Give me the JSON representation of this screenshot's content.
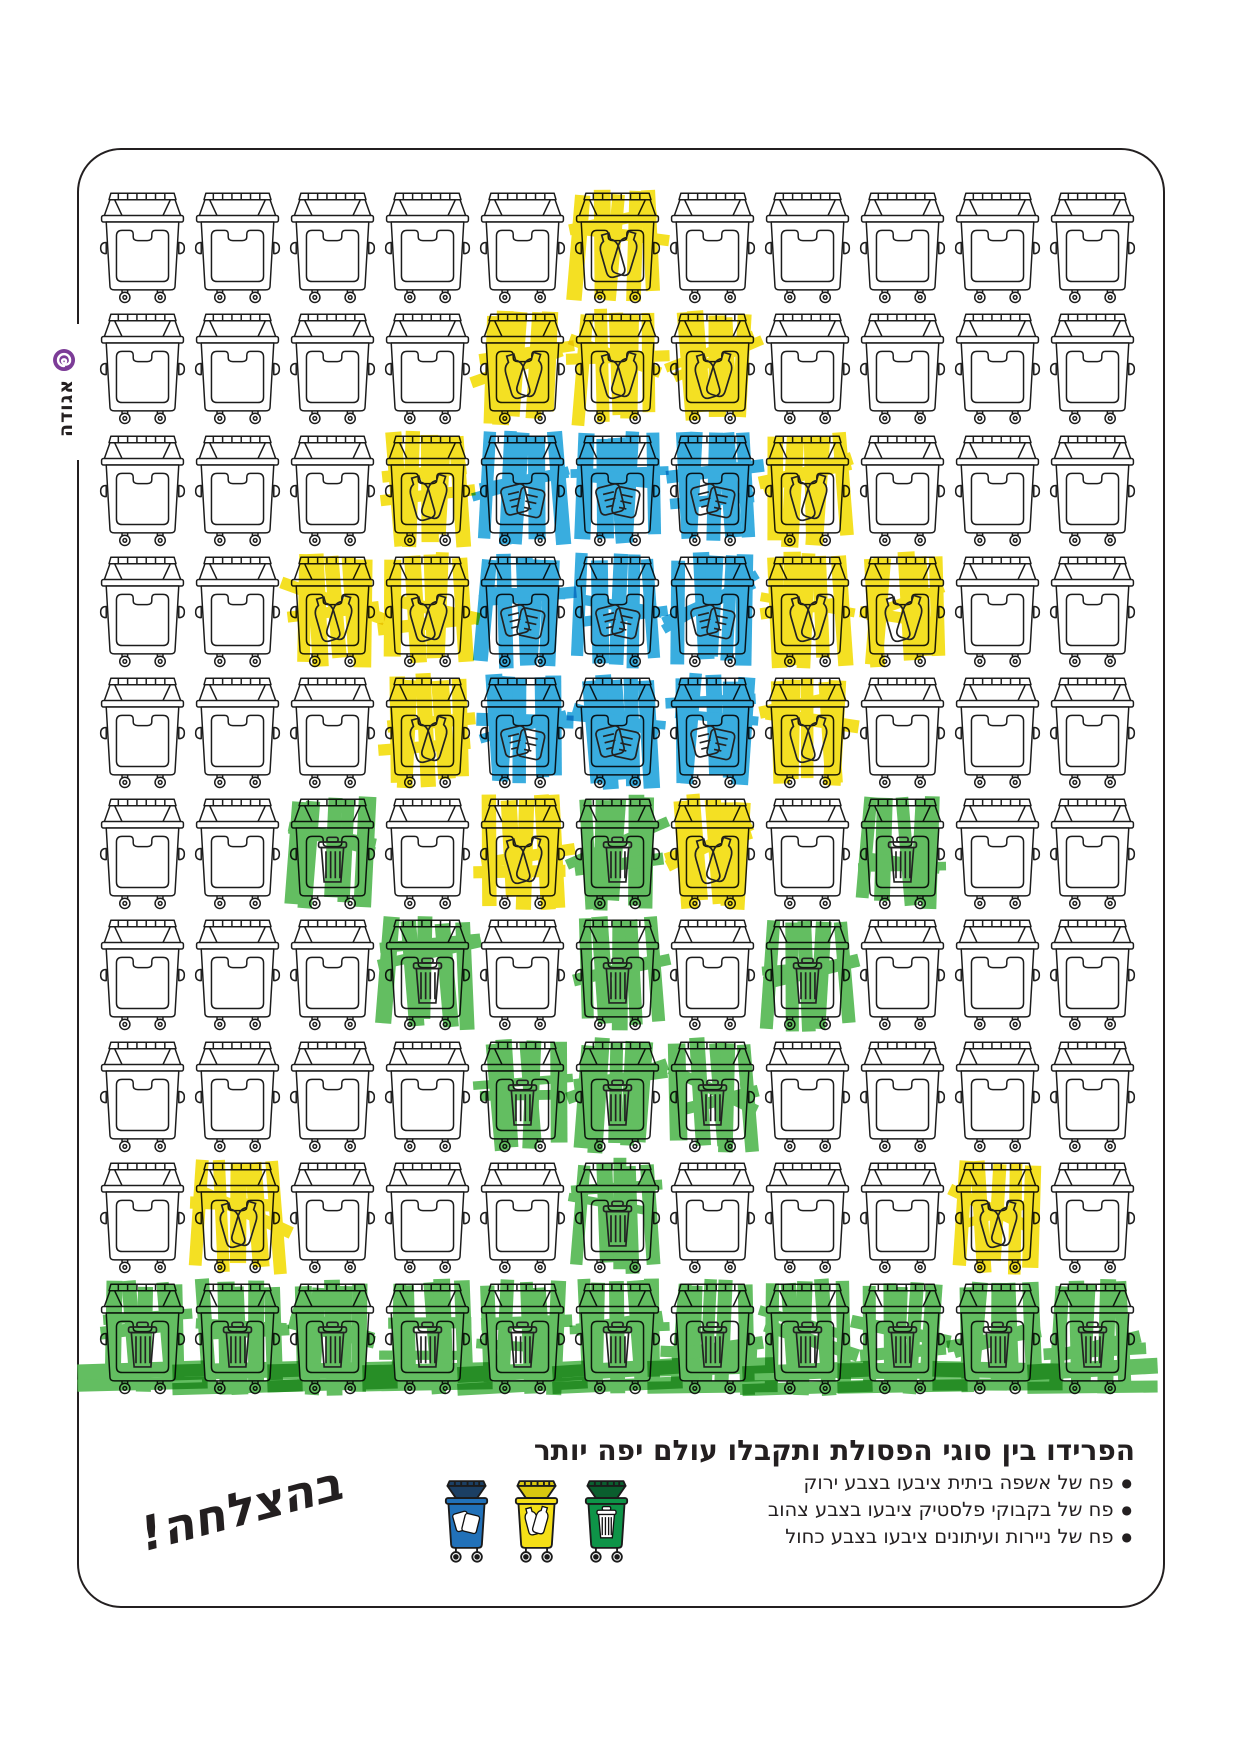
{
  "logo": {
    "text": "אגודה",
    "icon": "spiral-icon",
    "color": "#7c3c97"
  },
  "palette": {
    "ink": "#231f20",
    "yellow": "#f4df17",
    "blue": "#2ea9de",
    "green": "#5abb58",
    "legend_blue": "#2171b9",
    "legend_blue_lid": "#1b3f63",
    "legend_yellow": "#f4df17",
    "legend_yellow_lid": "#d9c70f",
    "legend_green": "#0e9448",
    "legend_green_lid": "#0a5e2e"
  },
  "grid": {
    "columns": 11,
    "rows": 10,
    "cells": [
      "WWWWWYWWWWW",
      "WWWWYYYWWWW",
      "WWWYBBBYWWW",
      "WWYYBBBYYWW",
      "WWWYBBBYWWW",
      "WWGWYGYWGWW",
      "WWWGWGWGWWW",
      "WWWWGGGWWWW",
      "WYWWWGWWWYW",
      "GGGGGGGGGGG"
    ],
    "glyph_for_color": {
      "Y": "plastic-bottles",
      "B": "papers",
      "G": "trash-basket",
      "W": "none"
    }
  },
  "footer": {
    "title": "הפרידו בין סוגי הפסולת ותקבלו עולם יפה יותר",
    "bullet_char": "●",
    "bullets": [
      {
        "text": "פח של אשפה ביתית ציבעו בצבע ירוק"
      },
      {
        "text": "פח של בקבוקי פלסטיק ציבעו בצבע צהוב"
      },
      {
        "text": "פח של ניירות ועיתונים ציבעו בצבע כחול"
      }
    ],
    "legend_bins": [
      {
        "name": "paper-bin",
        "glyph": "papers",
        "color_key": "legend_blue",
        "lid_key": "legend_blue_lid"
      },
      {
        "name": "plastic-bin",
        "glyph": "plastic-bottles",
        "color_key": "legend_yellow",
        "lid_key": "legend_yellow_lid"
      },
      {
        "name": "household-bin",
        "glyph": "trash-basket",
        "color_key": "legend_green",
        "lid_key": "legend_green_lid"
      }
    ],
    "handwriting": "בהצלחה!"
  }
}
